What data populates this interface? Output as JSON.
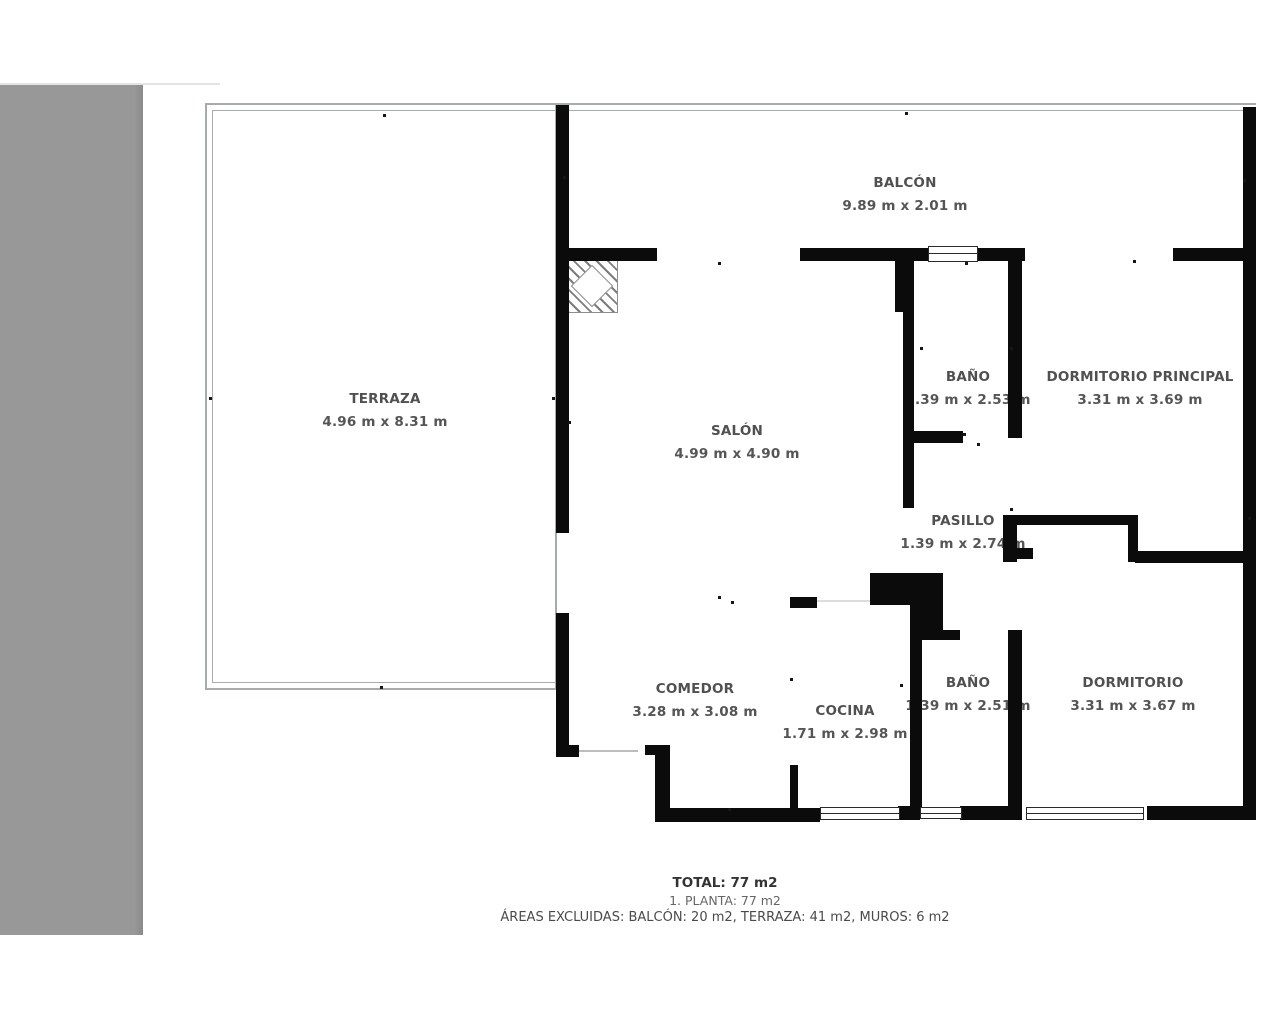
{
  "page": {
    "background": "#ffffff",
    "sidebar_color": "#989898",
    "wall_color": "#0b0b0b",
    "outline_color": "#a6abab",
    "label_color": "#505050"
  },
  "plan": {
    "rooms": [
      {
        "id": "terraza",
        "label": "TERRAZA",
        "dims": "4.96 m x 8.31 m"
      },
      {
        "id": "balcon",
        "label": "BALCÓN",
        "dims": "9.89 m x 2.01 m"
      },
      {
        "id": "salon",
        "label": "SALÓN",
        "dims": "4.99 m x 4.90 m"
      },
      {
        "id": "bano-1",
        "label": "BAÑO",
        "dims": "1.39 m x 2.53 m"
      },
      {
        "id": "dormitorio-principal",
        "label": "DORMITORIO PRINCIPAL",
        "dims": "3.31 m x 3.69 m"
      },
      {
        "id": "pasillo",
        "label": "PASILLO",
        "dims": "1.39 m x 2.74 m"
      },
      {
        "id": "comedor",
        "label": "COMEDOR",
        "dims": "3.28 m x 3.08 m"
      },
      {
        "id": "cocina",
        "label": "COCINA",
        "dims": "1.71 m x 2.98 m"
      },
      {
        "id": "bano-2",
        "label": "BAÑO",
        "dims": "1.39 m x 2.51 m"
      },
      {
        "id": "dormitorio",
        "label": "DORMITORIO",
        "dims": "3.31 m x 3.67 m"
      }
    ],
    "summary": {
      "total": "TOTAL: 77 m2",
      "planta": "1. PLANTA: 77 m2",
      "excluded": "ÁREAS EXCLUIDAS: BALCÓN: 20 m2, TERRAZA: 41 m2, MUROS: 6 m2"
    }
  }
}
